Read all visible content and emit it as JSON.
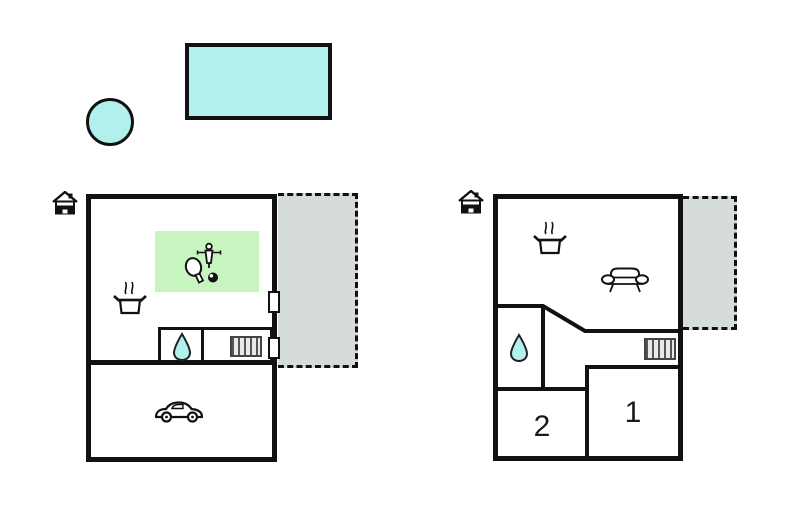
{
  "colors": {
    "line": "#111111",
    "water": "#b2f0ee",
    "game": "#c8f4c0",
    "terrace": "#d6dcda",
    "radiator_fill": "#e9e9e9",
    "radiator_line": "#555555",
    "label": "#1a1a1a"
  },
  "outdoor": {
    "pool": {
      "icon": "swimming-pool"
    },
    "hot_tub": {
      "icon": "hot-tub"
    }
  },
  "plan_left": {
    "entrance": {
      "icon": "house-entrance-icon"
    },
    "terrace": {
      "style": "dashed",
      "fill": "gray"
    },
    "game_area": {
      "icons": [
        "table-tennis-paddle-icon",
        "foosball-player-icon",
        "billiard-ball-icon"
      ]
    },
    "kitchen": {
      "icon": "cooking-pot-icon"
    },
    "bathroom": {
      "icon": "water-drop-icon"
    },
    "heating": {
      "icon": "radiator-icon"
    },
    "garage": {
      "icon": "car-icon"
    },
    "door_count": 2
  },
  "plan_right": {
    "entrance": {
      "icon": "house-entrance-icon"
    },
    "terrace": {
      "style": "dashed",
      "fill": "gray"
    },
    "kitchen": {
      "icon": "cooking-pot-icon"
    },
    "living": {
      "icon": "sofa-icon"
    },
    "bathroom": {
      "icon": "water-drop-icon"
    },
    "heating": {
      "icon": "radiator-icon"
    },
    "rooms": [
      {
        "label": "1"
      },
      {
        "label": "2"
      }
    ]
  }
}
